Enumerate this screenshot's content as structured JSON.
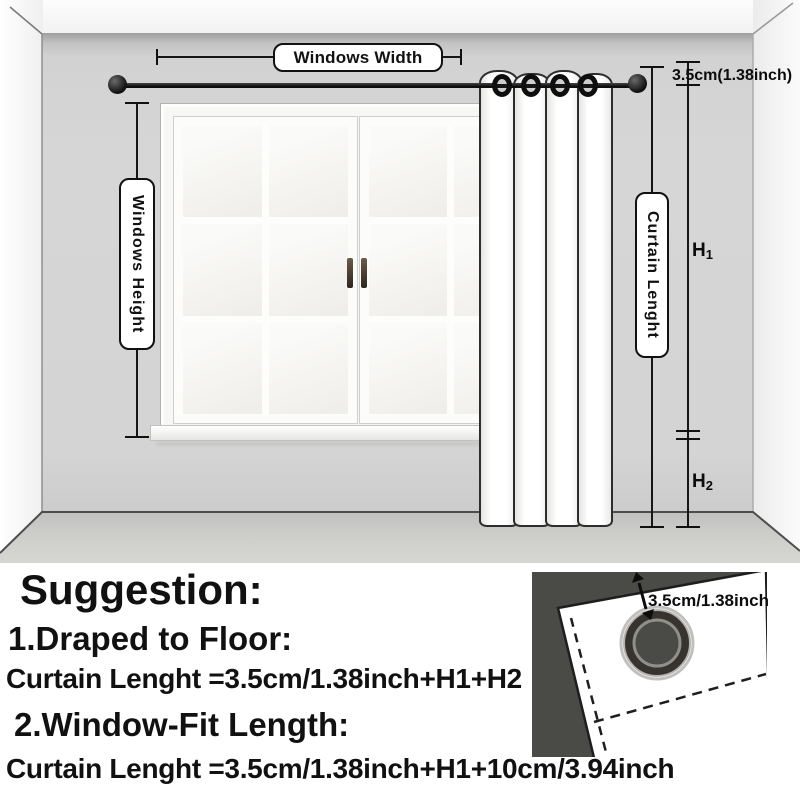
{
  "scene": {
    "labels": {
      "windows_width": "Windows Width",
      "windows_height": "Windows Height",
      "curtain_length": "Curtain Lenght",
      "rod_offset": "3.5cm(1.38inch)",
      "h1": {
        "letter": "H",
        "sub": "1"
      },
      "h2": {
        "letter": "H",
        "sub": "2"
      }
    }
  },
  "suggestion": {
    "title": "Suggestion:",
    "item1_title": "1.Draped to Floor:",
    "item1_formula": "Curtain Lenght =3.5cm/1.38inch+H1+H2",
    "item2_title": "2.Window-Fit Length:",
    "item2_formula": "Curtain Lenght =3.5cm/1.38inch+H1+10cm/3.94inch"
  },
  "inset": {
    "grommet_offset_label": "3.5cm/1.38inch"
  },
  "colors": {
    "back_wall": "#d4d4d4",
    "floor": "#c7c7c5",
    "rod": "#111111",
    "curtain": "#ffffff",
    "annotation": "#111111",
    "inset_background": "#4a4a47"
  }
}
